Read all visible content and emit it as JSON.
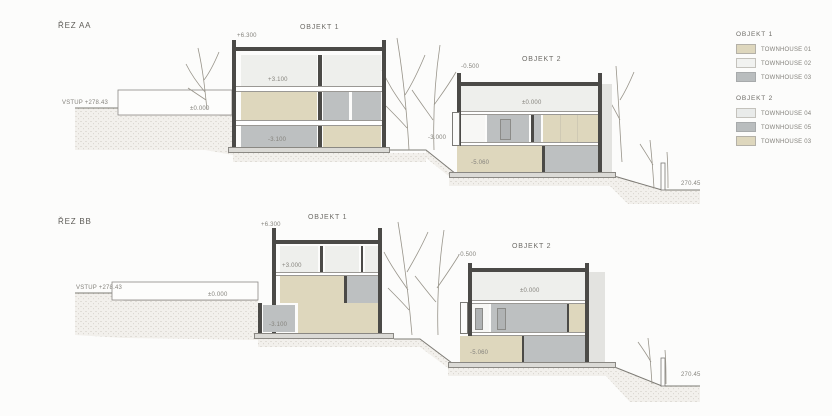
{
  "colors": {
    "beige": "#ded7bd",
    "light": "#eeefec",
    "grey": "#bdc0c1",
    "white_room": "#f7f7f5",
    "wall": "#4b4a47"
  },
  "sections": {
    "aa": {
      "label": "ŘEZ AA",
      "entry": "VSTUP +278.43",
      "terrace": "±0.000",
      "grade_right": "270.45",
      "o1": {
        "title": "OBJEKT 1",
        "roof": "+6.300",
        "lvl_top": "+3.100",
        "lvl_bottom": "-3.100"
      },
      "o2": {
        "title": "OBJEKT 2",
        "parapet": "-0.500",
        "lvl_main": "±0.000",
        "lvl_side": "-3.000",
        "lvl_bottom": "-5.060"
      }
    },
    "bb": {
      "label": "ŘEZ BB",
      "entry": "VSTUP +278.43",
      "terrace": "±0.000",
      "grade_right": "270.45",
      "o1": {
        "title": "OBJEKT 1",
        "roof": "+6.300",
        "lvl_top": "+3.000",
        "lvl_bottom": "-3.100"
      },
      "o2": {
        "title": "OBJEKT 2",
        "parapet": "-0.500",
        "lvl_main": "±0.000",
        "lvl_bottom": "-5.060"
      }
    }
  },
  "legend": {
    "groups": [
      {
        "title": "OBJEKT 1",
        "items": [
          {
            "label": "TOWNHOUSE 01",
            "color": "#ded7bd"
          },
          {
            "label": "TOWNHOUSE 02",
            "color": "#f1f2f0"
          },
          {
            "label": "TOWNHOUSE 03",
            "color": "#b9bdbe"
          }
        ]
      },
      {
        "title": "OBJEKT 2",
        "items": [
          {
            "label": "TOWNHOUSE 04",
            "color": "#e9ebea"
          },
          {
            "label": "TOWNHOUSE 05",
            "color": "#b9bdbe"
          },
          {
            "label": "TOWNHOUSE 03",
            "color": "#ded7bd"
          }
        ]
      }
    ]
  }
}
